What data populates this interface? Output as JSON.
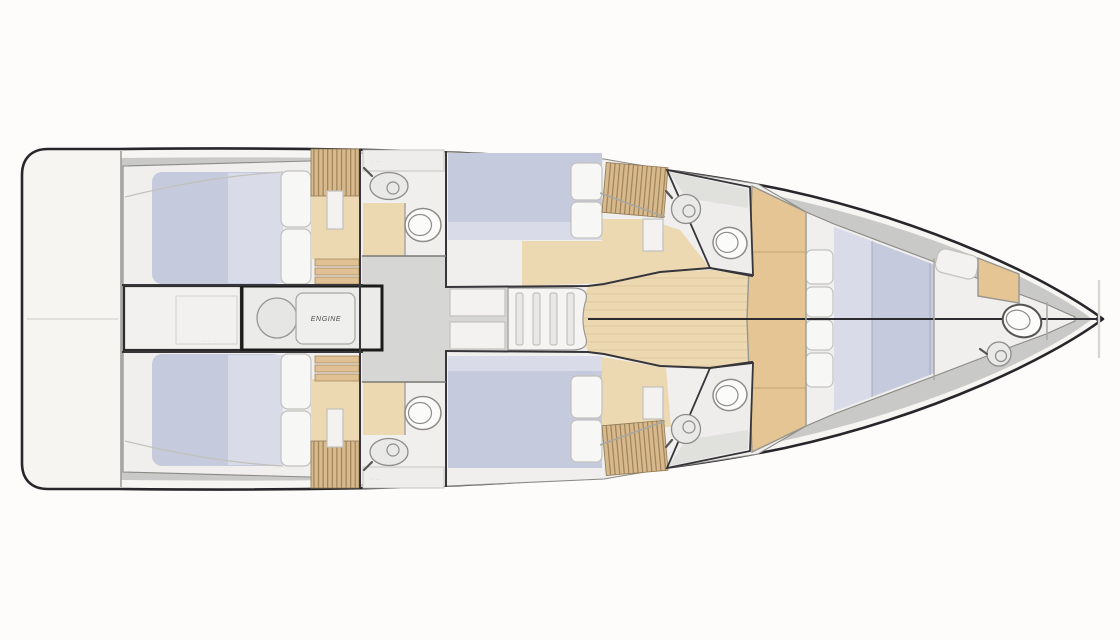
{
  "plan": {
    "labels": {
      "engine": "ENGINE",
      "storage_marks": "· · ·",
      "counter_marks_port": "· ··",
      "counter_marks_starboard": "· ··"
    },
    "colors": {
      "outline": "#26262b",
      "hull": "#f6f5f2",
      "deck": "#c9c9c7",
      "interior": "#f0efed",
      "corridor": "#d6d6d4",
      "wall": "#35353a",
      "wood": "#ecd8b1",
      "woodmid": "#e5c593",
      "slat": "#d6b98c",
      "slatline": "#9c7c52",
      "step": "#dfc194",
      "mattress": "#c6cadd",
      "mattress_light": "#d9dce8",
      "pillow": "#f7f7f5",
      "fixture": "#8d8c88",
      "engine_border": "#1b1b19"
    }
  }
}
